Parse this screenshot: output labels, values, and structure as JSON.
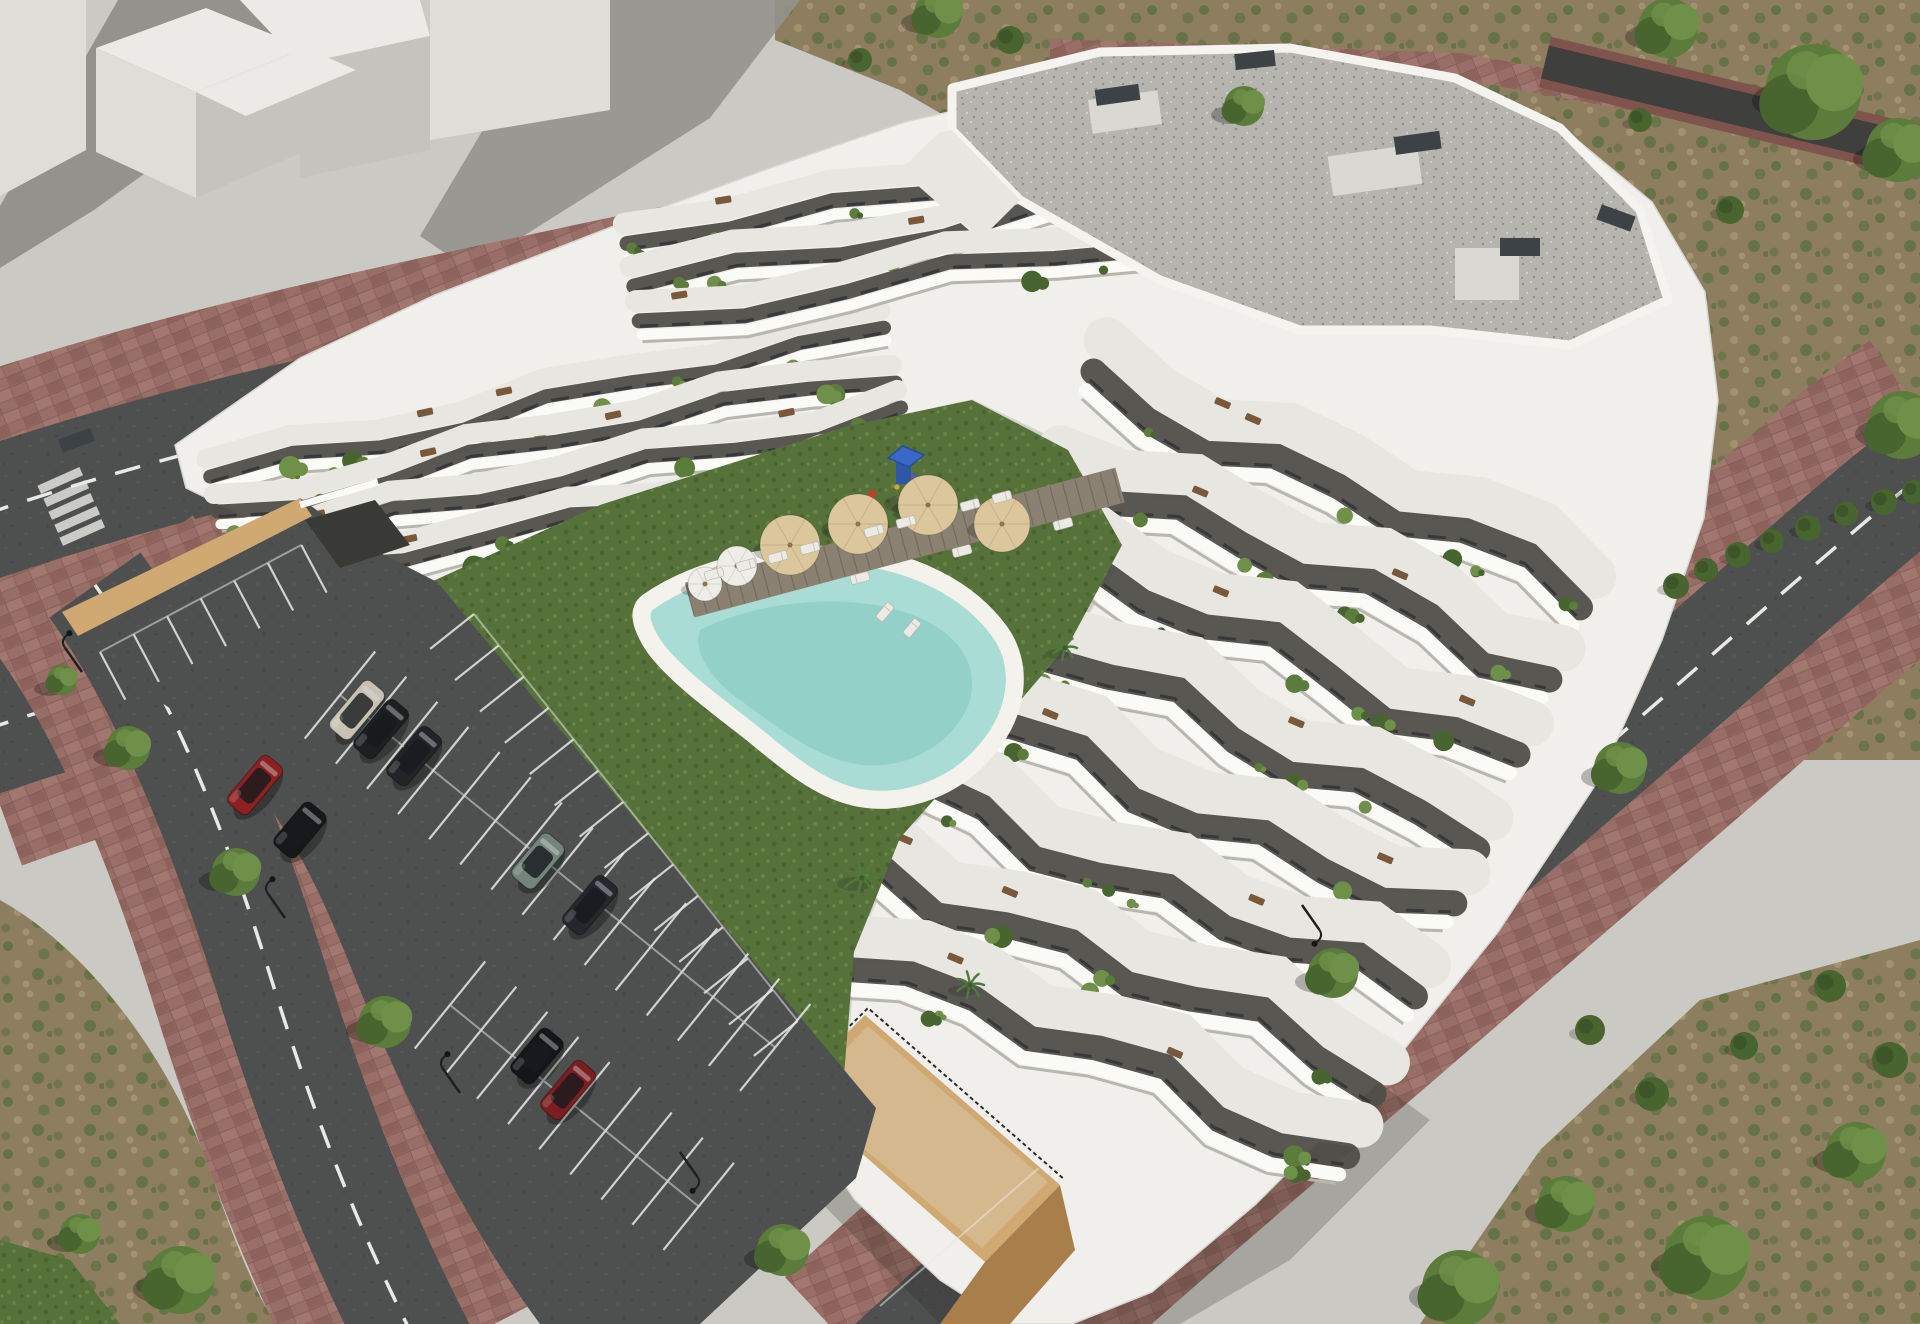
{
  "scene": {
    "title": "Aerial 3D architectural rendering of a new-build apartment complex",
    "type": "architectural_rendering",
    "time_of_day": "day",
    "no_visible_text": true,
    "elements": [
      "terraced white apartment building",
      "communal lawn courtyard",
      "freeform swimming pool",
      "wooden sun deck",
      "children playground",
      "surface parking lot with cars",
      "perimeter streets with red paver sidewalks",
      "untextured neighbour massing blocks",
      "scrubland plots",
      "street trees"
    ]
  },
  "palette": {
    "ground": "#cbc9c3",
    "ground_shadow": "#94928d",
    "block_top": "#eceae6",
    "block_front": "#dfddd8",
    "block_side": "#c5c3be",
    "scrub": "#8e7e60",
    "scrub_green": "#5e7040",
    "scrub_light": "#a3926f",
    "grass": "#57713a",
    "grass_dark": "#4a6130",
    "grass_light": "#6a8549",
    "asphalt": "#4e4f4f",
    "asphalt_dark": "#3f3f3e",
    "road_dash": "#e8e8e5",
    "paver": "#996e66",
    "paver_dark": "#7f544d",
    "paver_light": "#ad827a",
    "tan_wall": "#cfa872",
    "tan_wall_dark": "#a87f4b",
    "tan_wall_deep": "#8f6a3c",
    "building": "#f0efeb",
    "band_white": "#fafaf7",
    "band_shadow": "#b9b6b0",
    "facade": "#4f4e4a",
    "facade_deep": "#393936",
    "floor": "#e8e6e1",
    "glass_dark": "#2e3134",
    "roof_gravel": "#b6b4af",
    "roof_dot": "#908e89",
    "parapet": "#f4f3ef",
    "bulkhead": "#dad8d3",
    "vent": "#3d4247",
    "pool_rim": "#f3f2ed",
    "pool_water": "#a9dcd5",
    "pool_deep": "#7cc3bc",
    "deck_wood": "#8b8173",
    "deck_line": "#6e6355",
    "tree_a": "#5c7c3c",
    "tree_b": "#486530",
    "tree_c": "#6f9049",
    "bush_dark": "#3e5429",
    "palm": "#4f7a3a",
    "umbrella_cream": "#dcc69c",
    "umbrella_white": "#efede7",
    "umbrella_pole": "#8a734d",
    "lounger": "#eceae4",
    "furniture": "#7a583a",
    "rail": "#2b2b29",
    "lamp": "#1f1f1e",
    "car_window": "#171a1e",
    "white_line": "#e9e9e6",
    "shadow_soft": "rgba(35,35,30,0.22)"
  },
  "props": {
    "cars": [
      {
        "x": 357,
        "y": 710,
        "angle": -50,
        "color": "#c9c2b4",
        "type": "sedan"
      },
      {
        "x": 381,
        "y": 729,
        "angle": -50,
        "color": "#1e1f22",
        "type": "sedan"
      },
      {
        "x": 414,
        "y": 756,
        "angle": -50,
        "color": "#232428",
        "type": "sedan"
      },
      {
        "x": 255,
        "y": 785,
        "angle": -50,
        "color": "#8e2022",
        "type": "sedan"
      },
      {
        "x": 300,
        "y": 830,
        "angle": -50,
        "color": "#17181a",
        "type": "suv"
      },
      {
        "x": 538,
        "y": 861,
        "angle": -50,
        "color": "#74847a",
        "type": "suv"
      },
      {
        "x": 590,
        "y": 905,
        "angle": -50,
        "color": "#26262e",
        "type": "sedan"
      },
      {
        "x": 537,
        "y": 1056,
        "angle": -50,
        "color": "#151619",
        "type": "suv"
      },
      {
        "x": 568,
        "y": 1090,
        "angle": -50,
        "color": "#7e1d20",
        "type": "sedan"
      }
    ],
    "trees": [
      {
        "x": 128,
        "y": 748,
        "r": 22
      },
      {
        "x": 236,
        "y": 872,
        "r": 24
      },
      {
        "x": 385,
        "y": 1022,
        "r": 26
      },
      {
        "x": 62,
        "y": 680,
        "r": 15
      },
      {
        "x": 180,
        "y": 1280,
        "r": 34
      },
      {
        "x": 80,
        "y": 1234,
        "r": 20
      },
      {
        "x": 783,
        "y": 1250,
        "r": 26
      },
      {
        "x": 1333,
        "y": 973,
        "r": 25
      },
      {
        "x": 1620,
        "y": 768,
        "r": 26
      },
      {
        "x": 1902,
        "y": 425,
        "r": 34
      },
      {
        "x": 1813,
        "y": 92,
        "r": 48
      },
      {
        "x": 1668,
        "y": 28,
        "r": 30
      },
      {
        "x": 1898,
        "y": 150,
        "r": 32
      },
      {
        "x": 1460,
        "y": 1288,
        "r": 38
      },
      {
        "x": 1566,
        "y": 1204,
        "r": 28
      },
      {
        "x": 1706,
        "y": 1258,
        "r": 42
      },
      {
        "x": 1856,
        "y": 1152,
        "r": 30
      },
      {
        "x": 938,
        "y": 14,
        "r": 24
      },
      {
        "x": 1244,
        "y": 106,
        "r": 20
      }
    ],
    "bushes": [
      {
        "x": 1676,
        "y": 586,
        "r": 13
      },
      {
        "x": 1706,
        "y": 570,
        "r": 12
      },
      {
        "x": 1738,
        "y": 555,
        "r": 13
      },
      {
        "x": 1772,
        "y": 541,
        "r": 12
      },
      {
        "x": 1808,
        "y": 528,
        "r": 13
      },
      {
        "x": 1846,
        "y": 514,
        "r": 12
      },
      {
        "x": 1884,
        "y": 502,
        "r": 13
      },
      {
        "x": 1914,
        "y": 492,
        "r": 12
      },
      {
        "x": 1590,
        "y": 1030,
        "r": 15
      },
      {
        "x": 1652,
        "y": 1094,
        "r": 17
      },
      {
        "x": 1744,
        "y": 1046,
        "r": 14
      },
      {
        "x": 1830,
        "y": 986,
        "r": 16
      },
      {
        "x": 1890,
        "y": 1060,
        "r": 18
      },
      {
        "x": 1730,
        "y": 210,
        "r": 14
      },
      {
        "x": 1640,
        "y": 120,
        "r": 12
      },
      {
        "x": 860,
        "y": 60,
        "r": 12
      },
      {
        "x": 1010,
        "y": 40,
        "r": 14
      }
    ],
    "palms": [
      {
        "x": 862,
        "y": 878,
        "r": 17
      },
      {
        "x": 970,
        "y": 985,
        "r": 14
      },
      {
        "x": 1065,
        "y": 648,
        "r": 12
      },
      {
        "x": 700,
        "y": 1210,
        "r": 13
      }
    ],
    "umbrellas": [
      {
        "x": 790,
        "y": 545,
        "r": 30,
        "color": "cream"
      },
      {
        "x": 858,
        "y": 524,
        "r": 30,
        "color": "cream"
      },
      {
        "x": 928,
        "y": 505,
        "r": 30,
        "color": "cream"
      },
      {
        "x": 1002,
        "y": 524,
        "r": 28,
        "color": "cream"
      },
      {
        "x": 737,
        "y": 566,
        "r": 20,
        "color": "white"
      },
      {
        "x": 705,
        "y": 584,
        "r": 17,
        "color": "white"
      }
    ],
    "loungers": [
      {
        "x": 714,
        "y": 574,
        "angle": 75
      },
      {
        "x": 746,
        "y": 565,
        "angle": 75
      },
      {
        "x": 778,
        "y": 557,
        "angle": 75
      },
      {
        "x": 810,
        "y": 548,
        "angle": 75
      },
      {
        "x": 874,
        "y": 531,
        "angle": 75
      },
      {
        "x": 906,
        "y": 522,
        "angle": 75
      },
      {
        "x": 970,
        "y": 505,
        "angle": 75
      },
      {
        "x": 1002,
        "y": 497,
        "angle": 75
      },
      {
        "x": 860,
        "y": 578,
        "angle": -105
      },
      {
        "x": 962,
        "y": 551,
        "angle": -105
      },
      {
        "x": 1063,
        "y": 524,
        "angle": -105
      },
      {
        "x": 885,
        "y": 612,
        "angle": 40
      },
      {
        "x": 912,
        "y": 628,
        "angle": 40
      }
    ],
    "lamps": [
      {
        "x": 285,
        "y": 918,
        "rot": -35
      },
      {
        "x": 460,
        "y": 1093,
        "rot": -35
      },
      {
        "x": 82,
        "y": 672,
        "rot": -35
      },
      {
        "x": 680,
        "y": 1152,
        "rot": 145
      },
      {
        "x": 1302,
        "y": 905,
        "rot": 145
      }
    ],
    "playground": {
      "x": 888,
      "y": 446
    },
    "deck": {
      "x1": 690,
      "y1": 600,
      "x2": 1120,
      "y2": 485,
      "width": 36
    },
    "slot_rows": [
      {
        "x": 100,
        "y": 652,
        "angle": -28,
        "count": 7,
        "gap": 38,
        "len": 54,
        "side": 1
      },
      {
        "x": 340,
        "y": 695,
        "angle": 39,
        "count": 15,
        "gap": 40,
        "len": 56,
        "side": 2
      },
      {
        "x": 450,
        "y": 1005,
        "angle": 39,
        "count": 9,
        "gap": 40,
        "len": 56,
        "side": 2
      },
      {
        "x": 474,
        "y": 614,
        "angle": 51.5,
        "count": 14,
        "gap": 40,
        "len": 56,
        "side": 1
      },
      {
        "x": 880,
        "y": 1306,
        "angle": -41,
        "count": 6,
        "gap": 42,
        "len": 46,
        "side": -1
      }
    ],
    "wings": [
      {
        "name": "west-wing",
        "x": 205,
        "y": 452,
        "angle": -12,
        "length": 690,
        "floors": 4,
        "step": 40,
        "amp": 8,
        "seed": 3,
        "floor_w": 20,
        "floor_off": 6,
        "facade_w": 14,
        "facade_off": 24,
        "white_w": 10,
        "white_off": 37,
        "shrubs": 9,
        "furniture": 2
      },
      {
        "name": "north-wing",
        "x": 622,
        "y": 212,
        "angle": -9,
        "length": 840,
        "floors": 3,
        "step": 44,
        "amp": 9,
        "seed": 7,
        "floor_w": 22,
        "floor_off": 6,
        "facade_w": 15,
        "facade_off": 26,
        "white_w": 10,
        "white_off": 40,
        "shrubs": 8,
        "furniture": 2
      },
      {
        "name": "east-wing",
        "x": 1106,
        "y": 342,
        "angle": 23,
        "length": 540,
        "floors": 8,
        "step": 88,
        "amp": 14,
        "seed": 11,
        "floor_w": 46,
        "floor_off": 12,
        "facade_w": 26,
        "facade_off": 46,
        "white_w": 14,
        "white_off": 66,
        "shrubs": 6,
        "furniture": 2
      }
    ]
  }
}
